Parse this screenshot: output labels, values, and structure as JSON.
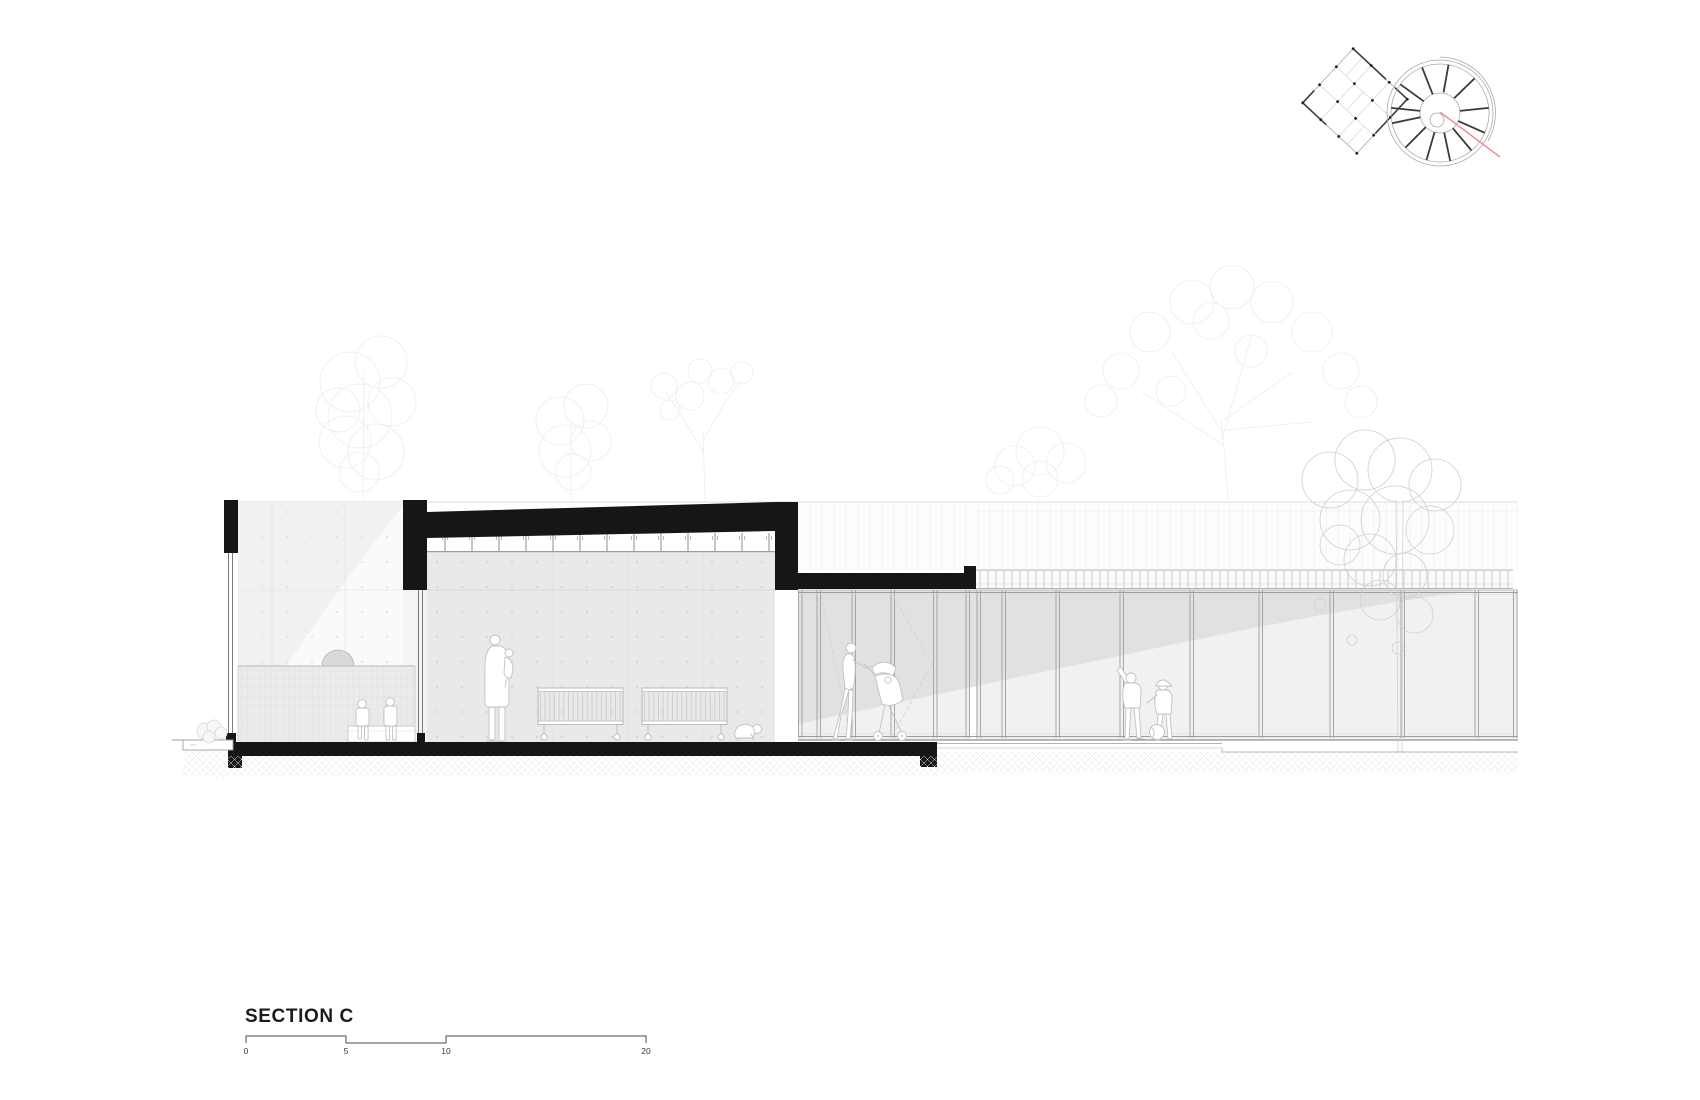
{
  "drawing": {
    "title": "SECTION C",
    "scale_labels": [
      "0",
      "5",
      "10",
      "20"
    ],
    "colors": {
      "ink": "#161616",
      "scale_line": "#4a4a4a",
      "section_line_red": "#ef8585",
      "concrete_light": "#f1f1f1",
      "concrete_mid": "#e9e9e9",
      "glass_tint": "#e1e1e1",
      "tile": "#ebebeb",
      "figure_outline": "#c2c2c2",
      "tree_faint": "#ededed",
      "tree_front": "#cfcfcf"
    },
    "figures": [
      "children-on-bench",
      "adult-carrying-child",
      "baby-cribs",
      "crawling-baby",
      "adult-with-stroller",
      "children-playing-ball"
    ],
    "key_plan": [
      "rect-building-plan",
      "round-building-plan",
      "red-section-cut-line"
    ]
  }
}
